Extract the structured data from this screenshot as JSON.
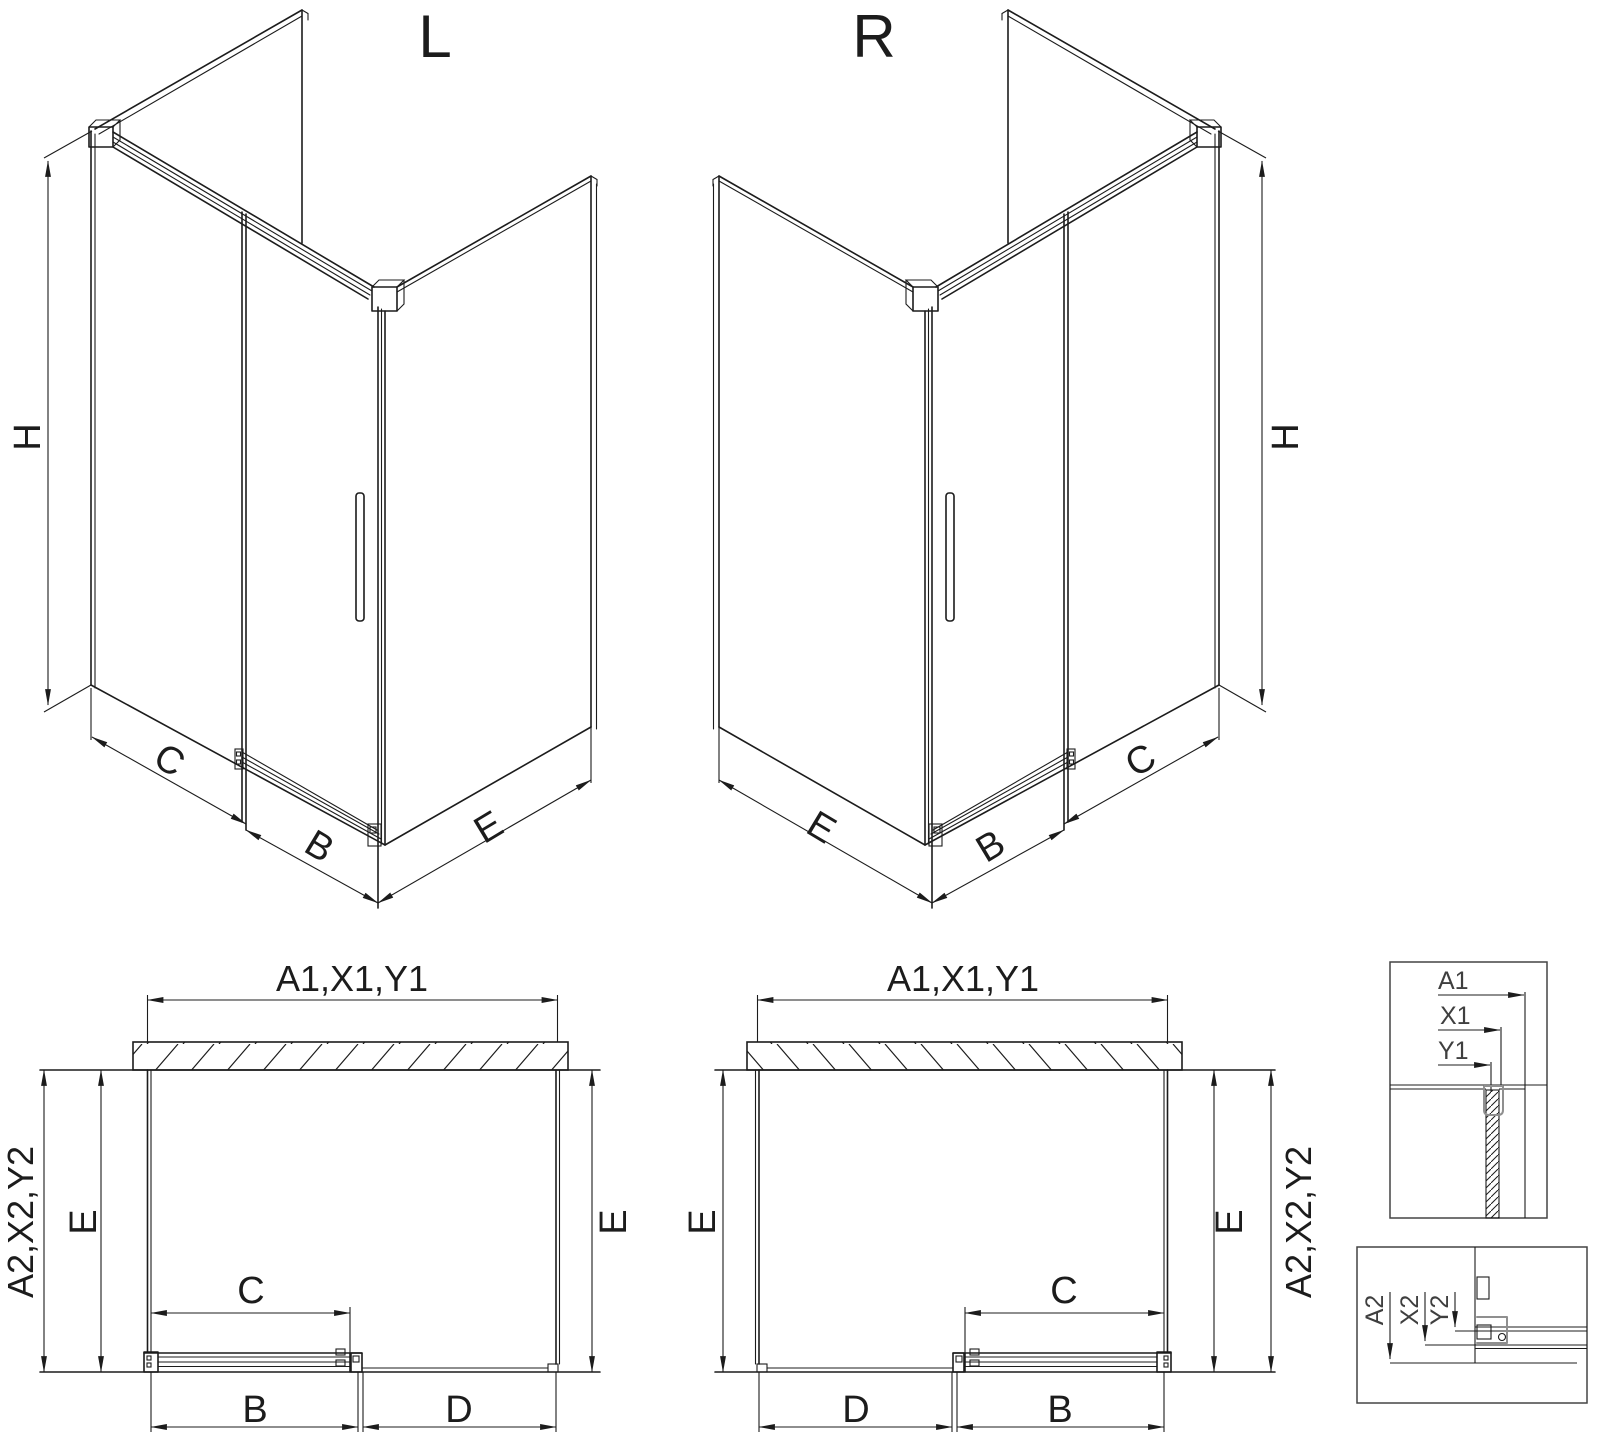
{
  "drawing": {
    "variants": {
      "left": "L",
      "right": "R"
    },
    "labels": {
      "height": "H",
      "opening": "C",
      "door_width": "B",
      "side_depth": "E",
      "fixed_width": "D",
      "front_group": "A1,X1,Y1",
      "depth_group": "A2,X2,Y2",
      "a1": "A1",
      "x1": "X1",
      "y1": "Y1",
      "a2": "A2",
      "x2": "X2",
      "y2": "Y2"
    },
    "colors": {
      "line": "#1c1c1c",
      "gray_accent": "#8f8f8f",
      "background": "#ffffff"
    }
  }
}
